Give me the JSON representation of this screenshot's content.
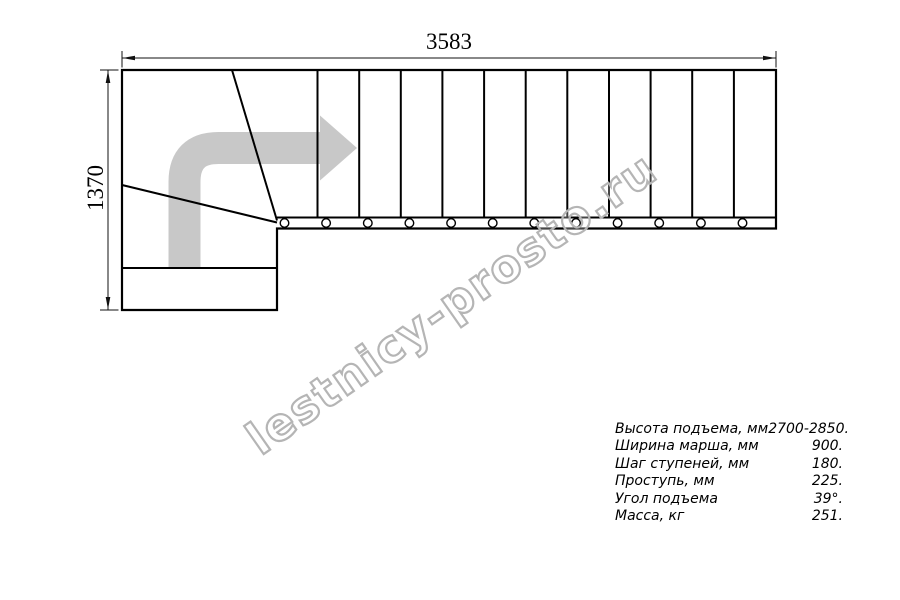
{
  "dimensions": {
    "top": "3583",
    "left": "1370"
  },
  "watermark": "lestnicy-prosto.ru",
  "specs": {
    "rows": [
      {
        "label": "Высота подъема, мм",
        "value": "2700-2850."
      },
      {
        "label": "Ширина марша, мм",
        "value": "900."
      },
      {
        "label": "Шаг ступеней, мм",
        "value": "180."
      },
      {
        "label": "Проступь, мм",
        "value": "225."
      },
      {
        "label": "Угол подъема",
        "value": "39°."
      },
      {
        "label": "Масса, кг",
        "value": "251."
      }
    ]
  },
  "colors": {
    "line": "#000000",
    "dimension_line": "#111111",
    "arrow_gray": "#c8c8c8",
    "watermark_gray": "#b5b5b5"
  },
  "stairs": {
    "straight_treads": 12,
    "winder_treads": 3,
    "mount_circles": 12
  }
}
